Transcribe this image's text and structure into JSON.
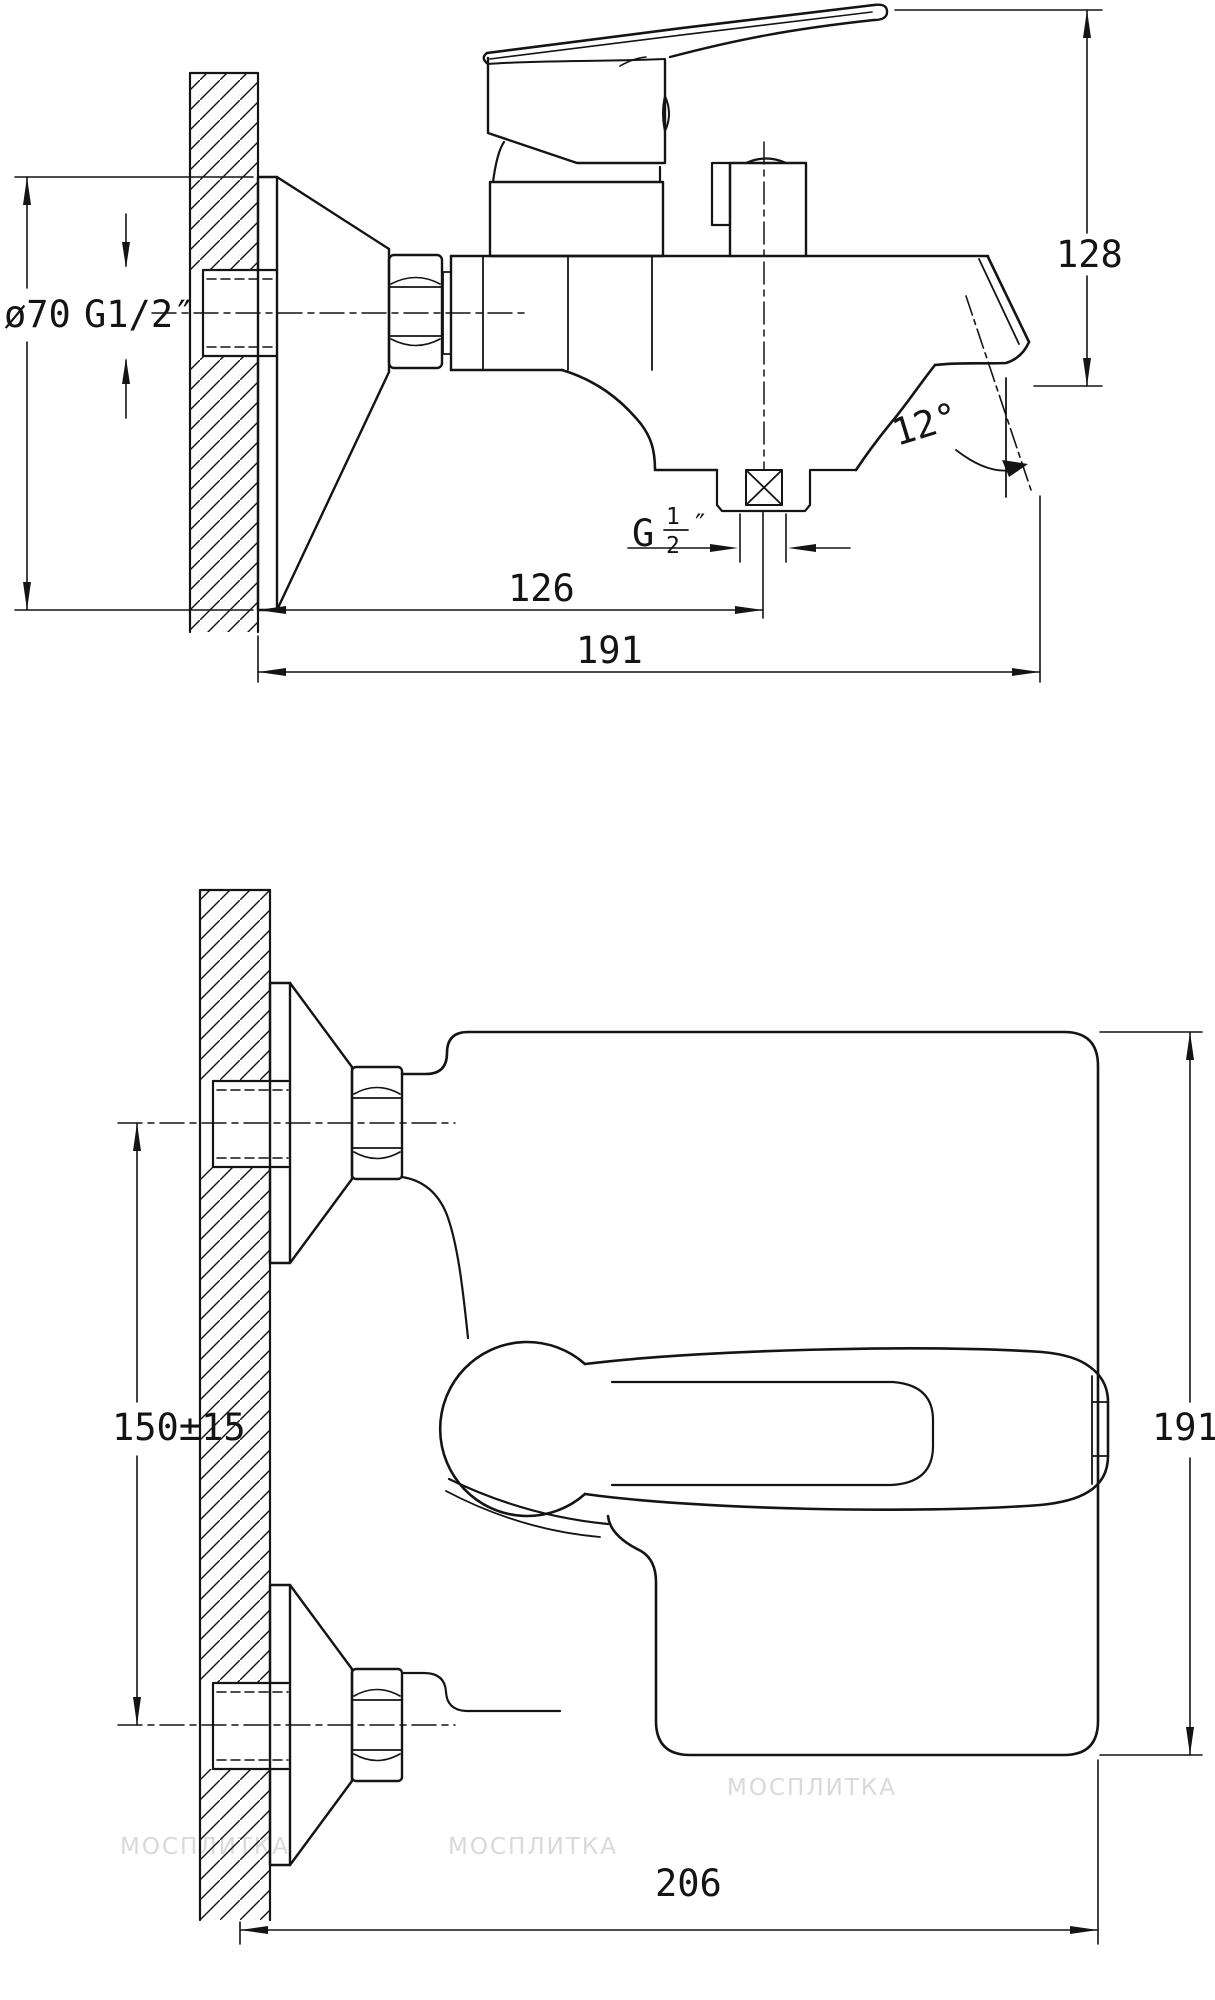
{
  "colors": {
    "line": "#141414",
    "background": "#ffffff",
    "watermark": "#d9d9d9"
  },
  "side_view": {
    "escutcheon_diameter": "ø70",
    "wall_thread": "G1/2″",
    "overall_height": "128",
    "spout_angle": "12°",
    "outlet_thread_prefix": "G",
    "outlet_thread_numerator": "1",
    "outlet_thread_denominator": "2",
    "outlet_thread_suffix": "″",
    "wall_to_shower_outlet": "126",
    "wall_to_spout_tip": "191"
  },
  "front_view": {
    "inlet_spacing": "150±15",
    "overall_height": "191",
    "overall_depth": "206"
  },
  "watermark": {
    "text": "МОСПЛИТКА"
  }
}
